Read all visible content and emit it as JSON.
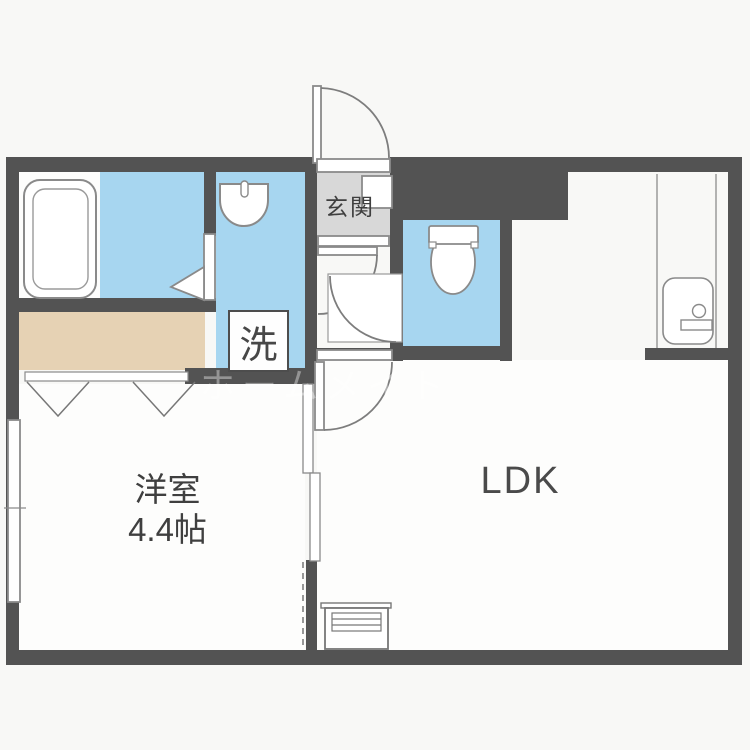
{
  "plan": {
    "rooms": {
      "genkan": {
        "label": "玄関"
      },
      "laundry": {
        "label": "洗"
      },
      "western_room": {
        "name": "洋室",
        "size": "4.4帖"
      },
      "ldk": {
        "label": "LDK"
      }
    },
    "watermark": {
      "text": "ホームメイト"
    },
    "fixtures": [
      "bathtub-icon",
      "washbasin-icon",
      "toilet-icon",
      "kitchen-sink-icon",
      "panel-heater-icon",
      "closet",
      "shoe-cabinet",
      "window",
      "entrance-door",
      "hinged-door",
      "sliding-door",
      "folding-closet-door"
    ],
    "colors": {
      "wall": "#535353",
      "wet_area": "#a7d6f0",
      "closet": "#e6d2b4",
      "genkan_floor": "#d8d8d8",
      "room_floor": "#fdfdfc",
      "background": "#f8f8f6",
      "fixture_line": "#8a8a8a",
      "text": "#3f3f3f"
    }
  }
}
